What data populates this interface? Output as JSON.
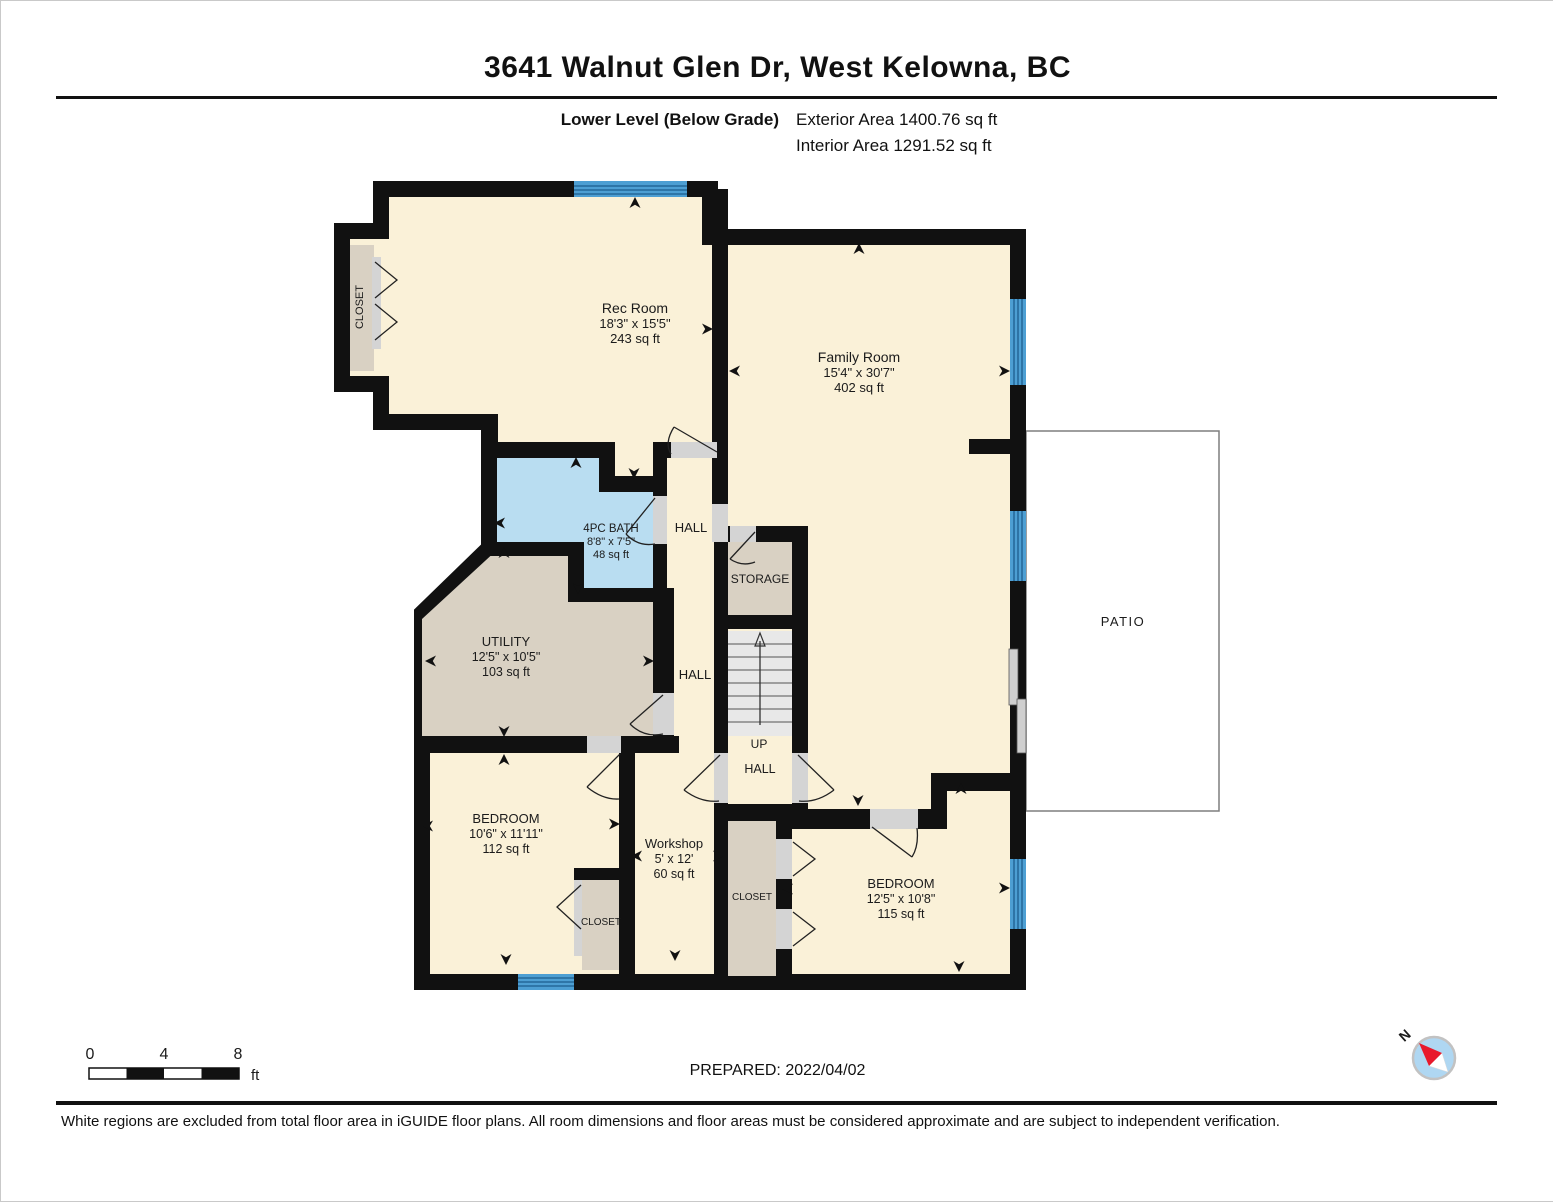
{
  "header": {
    "title": "3641 Walnut Glen Dr, West Kelowna, BC",
    "level_label": "Lower Level (Below Grade)",
    "exterior_area": "Exterior Area 1400.76 sq ft",
    "interior_area": "Interior Area 1291.52 sq ft"
  },
  "rooms": {
    "rec_room": {
      "name": "Rec Room",
      "dims": "18'3\" x 15'5\"",
      "area": "243 sq ft"
    },
    "family_room": {
      "name": "Family Room",
      "dims": "15'4\" x 30'7\"",
      "area": "402 sq ft"
    },
    "bath": {
      "name": "4PC BATH",
      "dims": "8'8\" x 7'5\"",
      "area": "48 sq ft"
    },
    "utility": {
      "name": "UTILITY",
      "dims": "12'5\" x 10'5\"",
      "area": "103 sq ft"
    },
    "bedroom_left": {
      "name": "BEDROOM",
      "dims": "10'6\" x 11'11\"",
      "area": "112 sq ft"
    },
    "workshop": {
      "name": "Workshop",
      "dims": "5' x 12'",
      "area": "60 sq ft"
    },
    "bedroom_right": {
      "name": "BEDROOM",
      "dims": "12'5\" x 10'8\"",
      "area": "115 sq ft"
    },
    "storage": {
      "name": "STORAGE"
    },
    "patio": {
      "name": "PATIO"
    },
    "hall_upper": {
      "name": "HALL"
    },
    "hall_mid": {
      "name": "HALL"
    },
    "stair_hall": {
      "up": "UP",
      "hall": "HALL"
    },
    "closet_rec": {
      "name": "CLOSET"
    },
    "closet_left": {
      "name": "CLOSET"
    },
    "closet_right": {
      "name": "CLOSET"
    }
  },
  "scale_bar": {
    "t0": "0",
    "t4": "4",
    "t8": "8",
    "unit": "ft"
  },
  "compass": {
    "label": "N"
  },
  "footer": {
    "prepared": "PREPARED: 2022/04/02",
    "disclaimer": "White regions are excluded from total floor area in iGUIDE floor plans. All room dimensions and floor areas must be considered approximate and are subject to independent verification."
  },
  "colors": {
    "room_fill": "#FAF1D8",
    "service_fill": "#D9D1C3",
    "bath_fill": "#B9DDF1",
    "wall": "#111111",
    "window": "#4D9FD3"
  }
}
